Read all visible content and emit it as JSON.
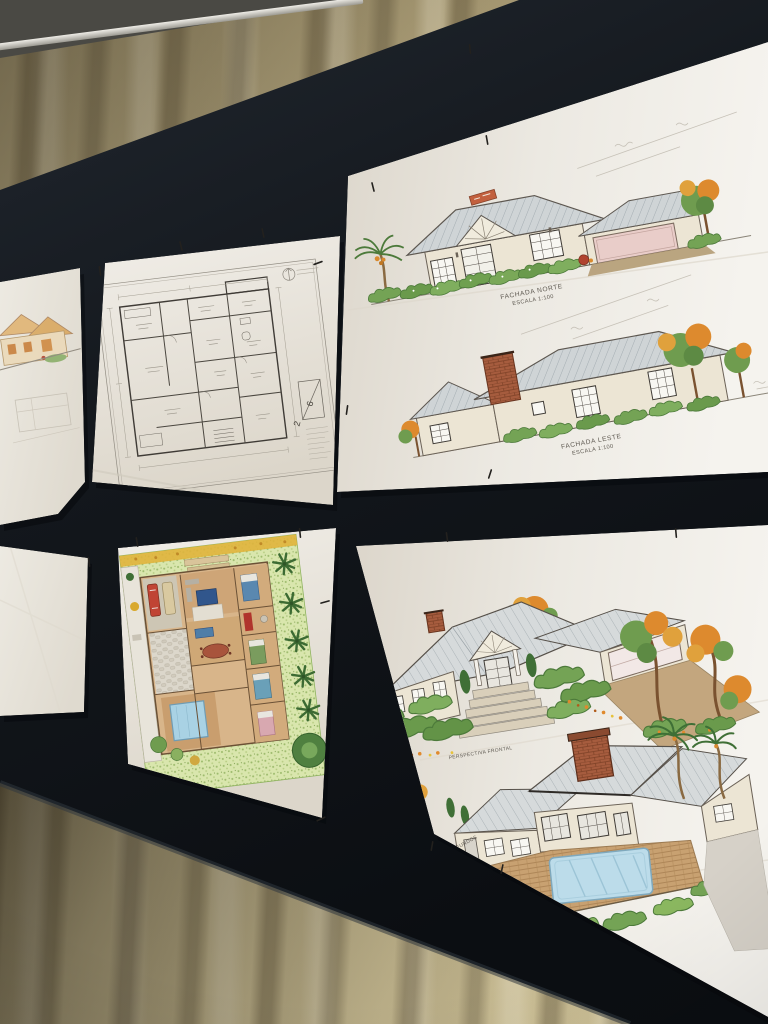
{
  "scene": {
    "description": "Photo of hand-drawn architectural presentation sheets pinned on a black display board in front of a beige curtain",
    "colors": {
      "curtain": "#c9bc92",
      "board": "#11151a",
      "paper": "#efece5",
      "ink": "#55504a",
      "foliage_green": "#74a355",
      "foliage_dark": "#3f6f36",
      "foliage_orange": "#dd8a2e",
      "roof_gray": "#cfd4d6",
      "brick": "#a65c3e",
      "wall_cream": "#ece5d4",
      "pool_blue": "#bcdcea",
      "wood": "#c8a171",
      "garage_pink": "#e9cdc9"
    }
  },
  "board": {
    "rows": 2,
    "columns": 3,
    "pinned_sheets": 6
  },
  "sheets": {
    "elevation_partial": {
      "name": "partial colored elevation sheet (cut off at left)"
    },
    "floor_plan": {
      "name": "technical floor plan sheet",
      "sheet_number": "2",
      "sheet_total": "6"
    },
    "elevations": {
      "name": "colored elevation sheet",
      "captions": [
        {
          "title": "FACHADA NORTE",
          "scale": "ESCALA 1:100"
        },
        {
          "title": "FACHADA LESTE",
          "scale": "ESCALA 1:100"
        }
      ]
    },
    "blank": {
      "name": "blank sheet"
    },
    "site_plan": {
      "name": "colored furnished site plan with pool and garden"
    },
    "perspectives": {
      "name": "colored perspective renderings sheet",
      "captions": [
        {
          "title": "PERSPECTIVA FRONTAL"
        },
        {
          "title": "PERSPECTIVA FUNDOS"
        }
      ]
    }
  }
}
